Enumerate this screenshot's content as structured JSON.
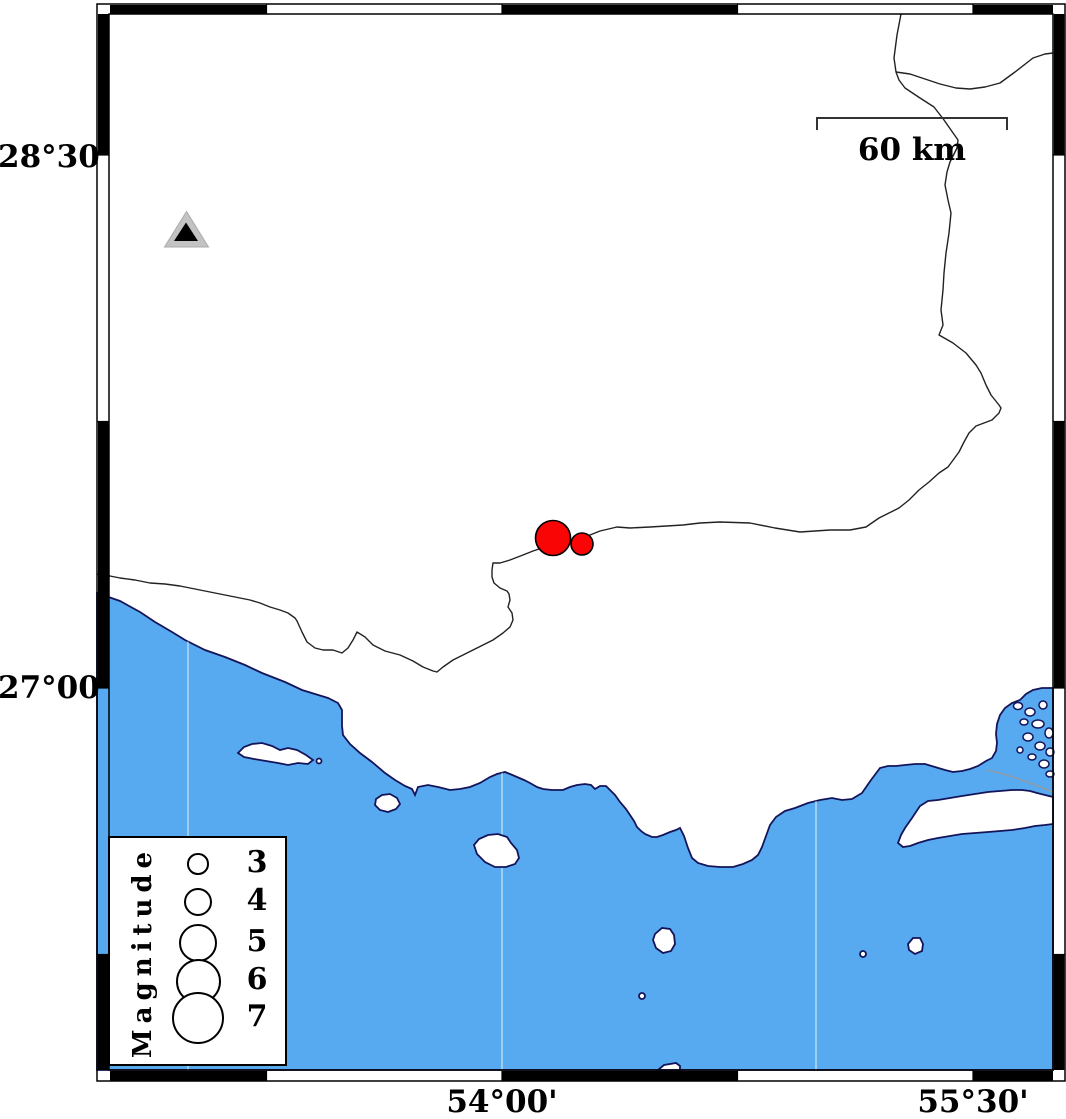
{
  "map": {
    "lat_labels": [
      {
        "text": "28°30'",
        "y": 157
      },
      {
        "text": "27°00'",
        "y": 688
      }
    ],
    "lon_labels": [
      {
        "text": "54°00'",
        "x": 502
      },
      {
        "text": "55°30'",
        "x": 973
      }
    ],
    "scale_bar": {
      "label": "60 km"
    },
    "colors": {
      "sea": "#58aaf0",
      "coast": "#14145a",
      "land": "#ffffff",
      "quake_fill": "#fa0505",
      "triangle_fill": "#c3c3c3",
      "triangle_inner": "#000000",
      "boundary_line": "#222222",
      "grid_line": "rgba(255,255,255,0.65)"
    },
    "earthquakes": [
      {
        "x": 553,
        "y": 538,
        "r": 17.5
      },
      {
        "x": 582,
        "y": 544,
        "r": 11
      }
    ],
    "station": {
      "x": 186.5,
      "y": 231
    },
    "gridlines_x": [
      188,
      502,
      816
    ]
  },
  "legend": {
    "title": "Magnitude",
    "circle_cx": 198,
    "num_cx": 257,
    "entries": [
      {
        "label": "3",
        "r": 10.8,
        "cy": 864
      },
      {
        "label": "4",
        "r": 14.2,
        "cy": 902
      },
      {
        "label": "5",
        "r": 19.2,
        "cy": 943
      },
      {
        "label": "6",
        "r": 22.5,
        "cy": 981
      },
      {
        "label": "7",
        "r": 26.3,
        "cy": 1018
      }
    ]
  }
}
